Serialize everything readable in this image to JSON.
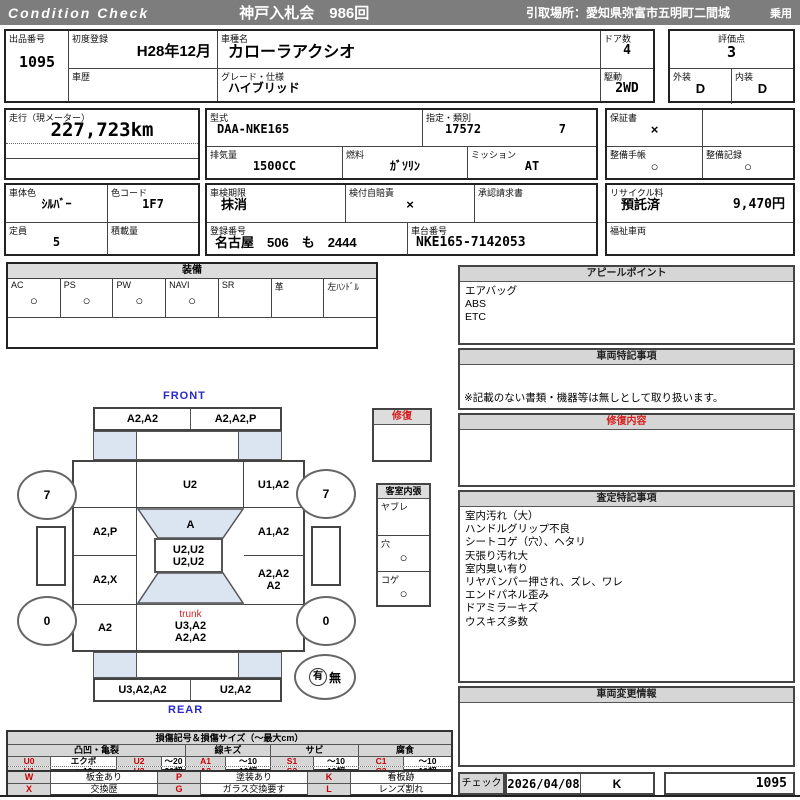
{
  "header": {
    "brand": "Condition  Check",
    "auction": "神戸入札会　986回",
    "pickup": "引取場所：愛知県弥富市五明町二間城",
    "category": "乗用"
  },
  "info": {
    "lot": {
      "label": "出品番号",
      "value": "1095"
    },
    "first_reg": {
      "label": "初度登録",
      "value": "H28年12月"
    },
    "history": {
      "label": "車歴",
      "value": ""
    },
    "model_name": {
      "label": "車種名",
      "value": "カローラアクシオ"
    },
    "grade": {
      "label": "グレード・仕様",
      "value": "ハイブリッド"
    },
    "doors": {
      "label": "ドア数",
      "value": "4"
    },
    "drive": {
      "label": "駆動",
      "value": "2WD"
    },
    "score": {
      "label": "評価点",
      "value": "3"
    },
    "exterior": {
      "label": "外装",
      "value": "D"
    },
    "interior": {
      "label": "内装",
      "value": "D"
    },
    "mileage": {
      "label": "走行（現メーター）",
      "value": "227,723km"
    },
    "model_code": {
      "label": "型式",
      "value": "DAA-NKE165"
    },
    "class": {
      "label": "指定・類別",
      "no": "17572",
      "sub": "7"
    },
    "warranty": {
      "label": "保証書",
      "value": "×"
    },
    "displacement": {
      "label": "排気量",
      "value": "1500CC"
    },
    "fuel": {
      "label": "燃料",
      "value": "ｶﾞｿﾘﾝ"
    },
    "mission": {
      "label": "ミッション",
      "value": "AT"
    },
    "book": {
      "label": "整備手帳",
      "value": "○"
    },
    "record": {
      "label": "整備記録",
      "value": "○"
    },
    "body_color": {
      "label": "車体色",
      "value": "ｼﾙﾊﾞｰ"
    },
    "color_code": {
      "label": "色コード",
      "value": "1F7"
    },
    "inspection": {
      "label": "車検期限",
      "value": "抹消"
    },
    "insurance": {
      "label": "検付自賠責",
      "value": "×"
    },
    "approval": {
      "label": "承認請求書",
      "value": ""
    },
    "recycle": {
      "label": "リサイクル料",
      "status": "預託済",
      "fee": "9,470円"
    },
    "capacity": {
      "label": "定員",
      "value": "5"
    },
    "load": {
      "label": "積載量",
      "value": ""
    },
    "reg_no": {
      "label": "登録番号",
      "value": "名古屋　506　も　2444"
    },
    "chassis": {
      "label": "車台番号",
      "value": "NKE165-7142053"
    },
    "welfare": {
      "label": "福祉車両",
      "value": ""
    }
  },
  "equipment": {
    "title": "装備",
    "items": [
      {
        "label": "AC",
        "value": "○"
      },
      {
        "label": "PS",
        "value": "○"
      },
      {
        "label": "PW",
        "value": "○"
      },
      {
        "label": "NAVI",
        "value": "○"
      },
      {
        "label": "SR",
        "value": ""
      },
      {
        "label": "革",
        "value": ""
      },
      {
        "label": "左ﾊﾝﾄﾞﾙ",
        "value": ""
      }
    ]
  },
  "panels": {
    "appeal": {
      "title": "アピールポイント",
      "lines": [
        "エアバッグ",
        "ABS",
        "ETC"
      ]
    },
    "special": {
      "title": "車両特記事項",
      "note": "※記載のない書類・機器等は無しとして取り扱います。"
    },
    "repair": {
      "title": "修復内容",
      "lines": []
    },
    "assessment": {
      "title": "査定特記事項",
      "lines": [
        "室内汚れ（大）",
        "ハンドルグリップ不良",
        "シートコゲ（穴）、ヘタリ",
        "天張り汚れ大",
        "室内臭い有り",
        "リヤバンパー押され、ズレ、ワレ",
        "エンドパネル歪み",
        "ドアミラーキズ",
        "ウスキズ多数"
      ]
    },
    "change": {
      "title": "車両変更情報",
      "lines": []
    },
    "check": {
      "label": "チェック",
      "date": "2026/04/08",
      "inspector": "K",
      "number": "1095"
    }
  },
  "interior_check": {
    "repair_title": "修復",
    "title": "客室内張",
    "rows": [
      {
        "label": "ヤブレ",
        "value": ""
      },
      {
        "label": "穴",
        "value": "○"
      },
      {
        "label": "コゲ",
        "value": "○"
      }
    ]
  },
  "diagram": {
    "front": "FRONT",
    "rear": "REAR",
    "trunk": "trunk",
    "cells": {
      "front_bumper_left": "A2,A2",
      "front_bumper_right": "A2,A2,P",
      "front_left_fender": "",
      "hood": "U2",
      "front_right_fender": "U1,A2",
      "left_front_door": "A2,P",
      "windshield": "A",
      "right_front_door": "A1,A2",
      "roof": "U2,U2\nU2,U2",
      "left_rear_door": "A2,X",
      "right_rear_door": "A2,A2\nA2",
      "left_quarter": "A2",
      "trunk_lines": "U3,A2\nA2,A2",
      "right_quarter": "",
      "rear_bumper_left": "U3,A2,A2",
      "rear_bumper_right": "U2,A2"
    },
    "tires": {
      "front_left": "7",
      "front_right": "7",
      "rear_left": "0",
      "rear_right": "0"
    },
    "spare": {
      "have": "有",
      "none": "無"
    }
  },
  "legend_damage": {
    "title": "損傷記号＆損傷サイズ（～最大cm）",
    "groups": [
      "凸凹・亀裂",
      "線キズ",
      "サビ",
      "腐食"
    ],
    "rows": [
      [
        "U0",
        "エクボ",
        "U2",
        "～20",
        "A1",
        "～10",
        "S1",
        "～10",
        "C1",
        "～10"
      ],
      [
        "U1",
        "～10",
        "U3",
        "20超",
        "A2",
        "10超",
        "S2",
        "10超",
        "C2",
        "10超"
      ]
    ]
  },
  "legend_marks": {
    "rows": [
      [
        {
          "code": "W",
          "label": "板金あり"
        },
        {
          "code": "P",
          "label": "塗装あり"
        },
        {
          "code": "K",
          "label": "看板跡"
        }
      ],
      [
        {
          "code": "X",
          "label": "交換歴"
        },
        {
          "code": "G",
          "label": "ガラス交換要す"
        },
        {
          "code": "L",
          "label": "レンズ割れ"
        }
      ]
    ]
  },
  "colors": {
    "header_bg": "#7d7d7d",
    "title_bg": "#d6d6d6",
    "red": "#d42020",
    "blue": "#2929c8",
    "light_blue": "#dbe5f1"
  }
}
